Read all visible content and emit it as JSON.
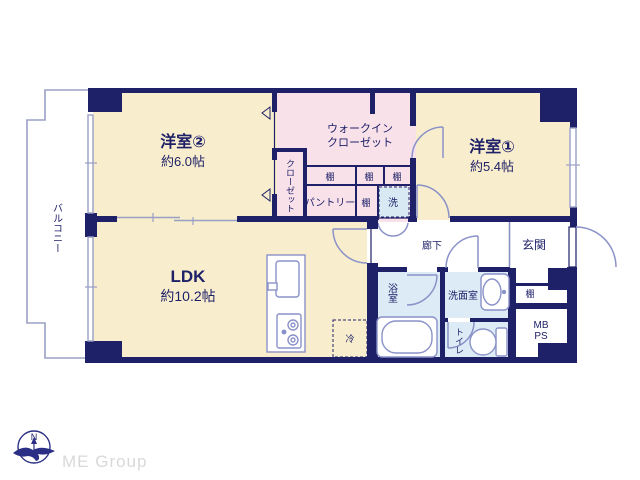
{
  "plan": {
    "balcony": {
      "label": "バルコニー"
    },
    "yoshitsu2": {
      "name": "洋室②",
      "size": "約6.0帖"
    },
    "closet": {
      "label": "クローゼット"
    },
    "wic": {
      "line1": "ウォークイン",
      "line2": "クローゼット"
    },
    "yoshitsu1": {
      "name": "洋室①",
      "size": "約5.4帖"
    },
    "shelves": {
      "wic_left": "棚",
      "wic_mid": "棚",
      "wic_right": "棚",
      "pantry_side": "棚",
      "entrance": "棚"
    },
    "pantry": {
      "label": "パントリー"
    },
    "laundry": {
      "label": "洗"
    },
    "ldk": {
      "name": "LDK",
      "size": "約10.2帖"
    },
    "fridge": {
      "label": "冷"
    },
    "hallway": {
      "label": "廊下"
    },
    "entrance": {
      "label": "玄関"
    },
    "bathroom": {
      "label": "浴室"
    },
    "washroom": {
      "label": "洗面室"
    },
    "toilet": {
      "label": "トイレ"
    },
    "mbps": {
      "line1": "MB",
      "line2": "PS"
    }
  },
  "footer": {
    "compass_n": "N",
    "logo_text": "ME Group"
  },
  "colors": {
    "wall_navy": "#1f2168",
    "room_cream": "#f8edcd",
    "storage_pink": "#f8e1e9",
    "wet_blue": "#dcebf5",
    "fixture_line": "#8a92c8",
    "balcony_line": "#9aa0c5",
    "logo_gray": "#d9d9d9"
  }
}
